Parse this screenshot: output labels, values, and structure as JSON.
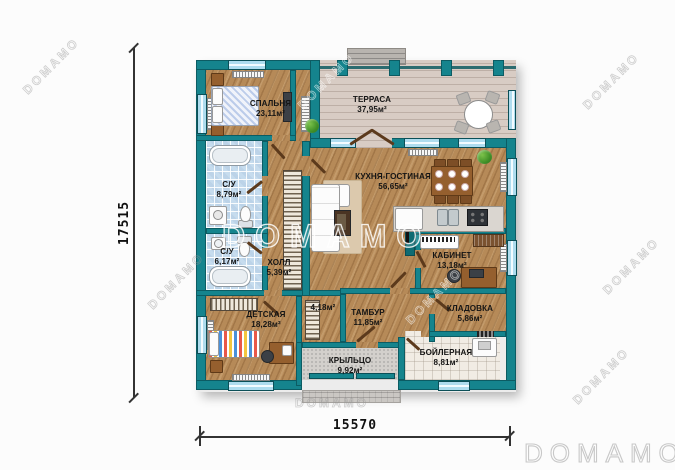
{
  "branding": {
    "logo": "DOMAMO",
    "watermark": "DOMAMO"
  },
  "dimensions": {
    "height_label": "17515",
    "width_label": "15570"
  },
  "rooms": [
    {
      "id": "bedroom",
      "name": "СПАЛЬНЯ",
      "area": "23,11м²"
    },
    {
      "id": "terrace",
      "name": "ТЕРРАСА",
      "area": "37,95м²"
    },
    {
      "id": "kitchen-living",
      "name": "КУХНЯ-ГОСТИНАЯ",
      "area": "56,65м²"
    },
    {
      "id": "bathroom-1",
      "name": "С/У",
      "area": "8,79м²"
    },
    {
      "id": "bathroom-2",
      "name": "С/У",
      "area": "6,17м²"
    },
    {
      "id": "hall",
      "name": "ХОЛЛ",
      "area": "5,39м²"
    },
    {
      "id": "study",
      "name": "КАБИНЕТ",
      "area": "13,18м²"
    },
    {
      "id": "kids-room",
      "name": "ДЕТСКАЯ",
      "area": "18,28м²"
    },
    {
      "id": "wardrobe-room",
      "name": "",
      "area": "4,18м²"
    },
    {
      "id": "tambour",
      "name": "ТАМБУР",
      "area": "11,85м²"
    },
    {
      "id": "storage",
      "name": "КЛАДОВКА",
      "area": "5,86м²"
    },
    {
      "id": "porch",
      "name": "КРЫЛЬЦО",
      "area": "9,92м²"
    },
    {
      "id": "boiler-room",
      "name": "БОЙЛЕРНАЯ",
      "area": "8,81м²"
    }
  ],
  "colors": {
    "wall": "#15848d",
    "wood_floor": "#b68a58",
    "terrace_floor": "#d8ccc4",
    "tile_blue": "#c6dcee",
    "porch_tile": "#d3d0cc",
    "boiler_tile": "#f1ece4",
    "door": "#5c3a1c"
  }
}
